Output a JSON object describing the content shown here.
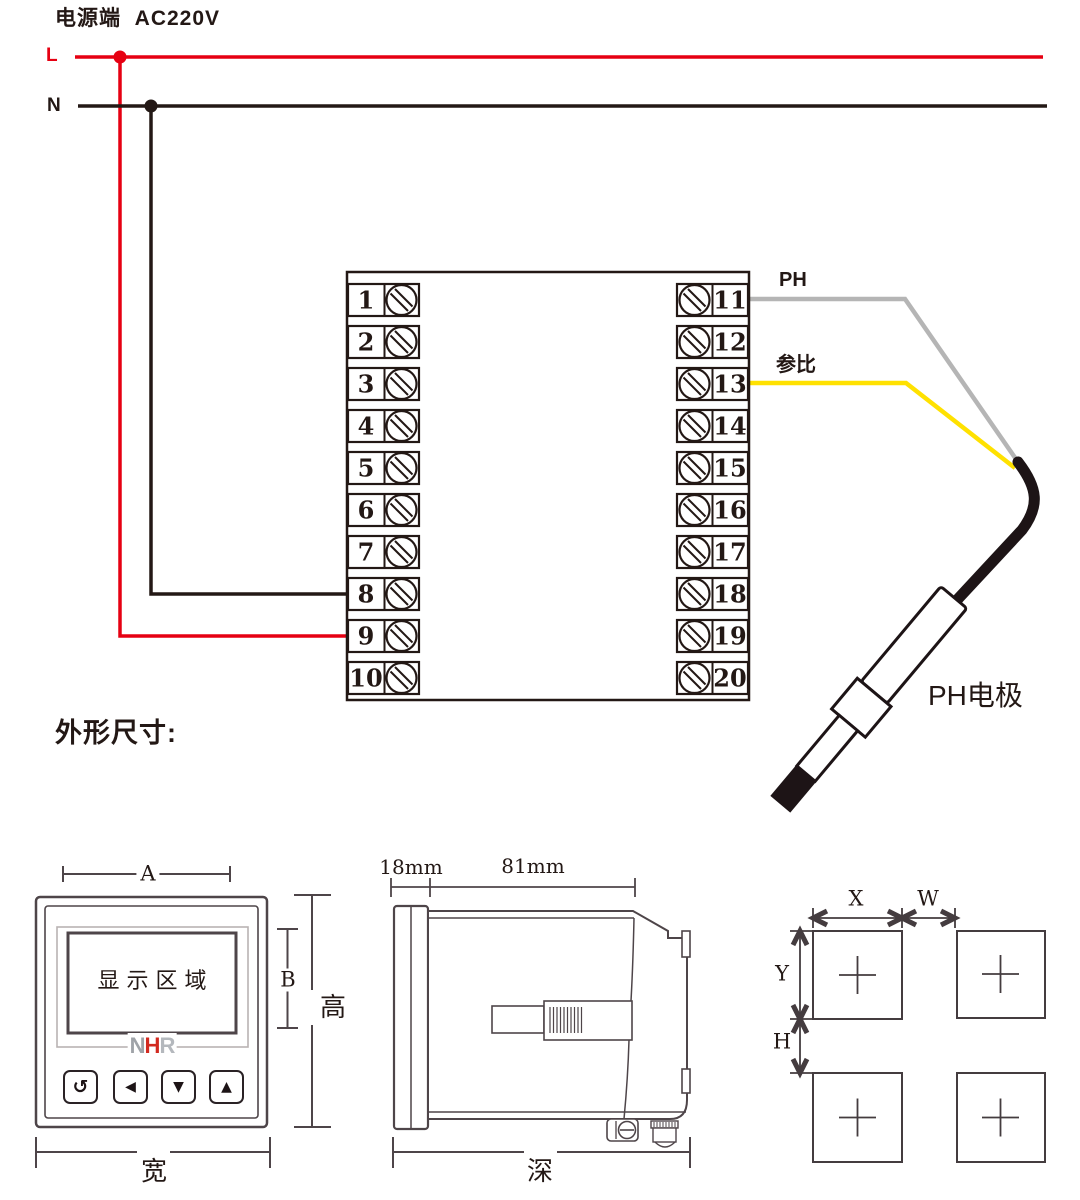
{
  "power": {
    "title": "电源端  AC220V",
    "line_live": "L",
    "line_neutral": "N",
    "live_color": "#e60012",
    "neutral_color": "#231815",
    "live_terminal": "9",
    "neutral_terminal": "8"
  },
  "terminal_block": {
    "rows": [
      {
        "left": "1",
        "right": "11"
      },
      {
        "left": "2",
        "right": "12"
      },
      {
        "left": "3",
        "right": "13"
      },
      {
        "left": "4",
        "right": "14"
      },
      {
        "left": "5",
        "right": "15"
      },
      {
        "left": "6",
        "right": "16"
      },
      {
        "left": "7",
        "right": "17"
      },
      {
        "left": "8",
        "right": "18"
      },
      {
        "left": "9",
        "right": "19"
      },
      {
        "left": "10",
        "right": "20"
      }
    ]
  },
  "sensor": {
    "ph_label": "PH",
    "ref_label": "参比",
    "electrode_label": "PH电极",
    "ph_wire_color": "#b5b5b5",
    "ref_wire_color": "#ffe100",
    "ph_terminal": "11",
    "ref_terminal": "13"
  },
  "dimensions_section": {
    "title": "外形尺寸:",
    "front_view": {
      "dim_a": "A",
      "dim_b": "B",
      "height_label": "高",
      "width_label": "宽",
      "display_text": "显示区域",
      "logo": {
        "n": "N",
        "h": "H",
        "r": "R"
      },
      "buttons": [
        {
          "name": "return",
          "icon": "↺"
        },
        {
          "name": "left",
          "icon": "◀"
        },
        {
          "name": "down",
          "icon": "▼"
        },
        {
          "name": "up",
          "icon": "▲"
        }
      ]
    },
    "side_view": {
      "dim_front": "18mm",
      "dim_body": "81mm",
      "depth_label": "深"
    },
    "cutout_view": {
      "dim_x": "X",
      "dim_w": "W",
      "dim_y": "Y",
      "dim_h": "H"
    }
  },
  "colors": {
    "accent_red": "#e60012",
    "wire_yellow": "#ffe100",
    "wire_gray": "#b5b5b5",
    "ink": "#231815",
    "drawing_line": "#4e4549"
  }
}
